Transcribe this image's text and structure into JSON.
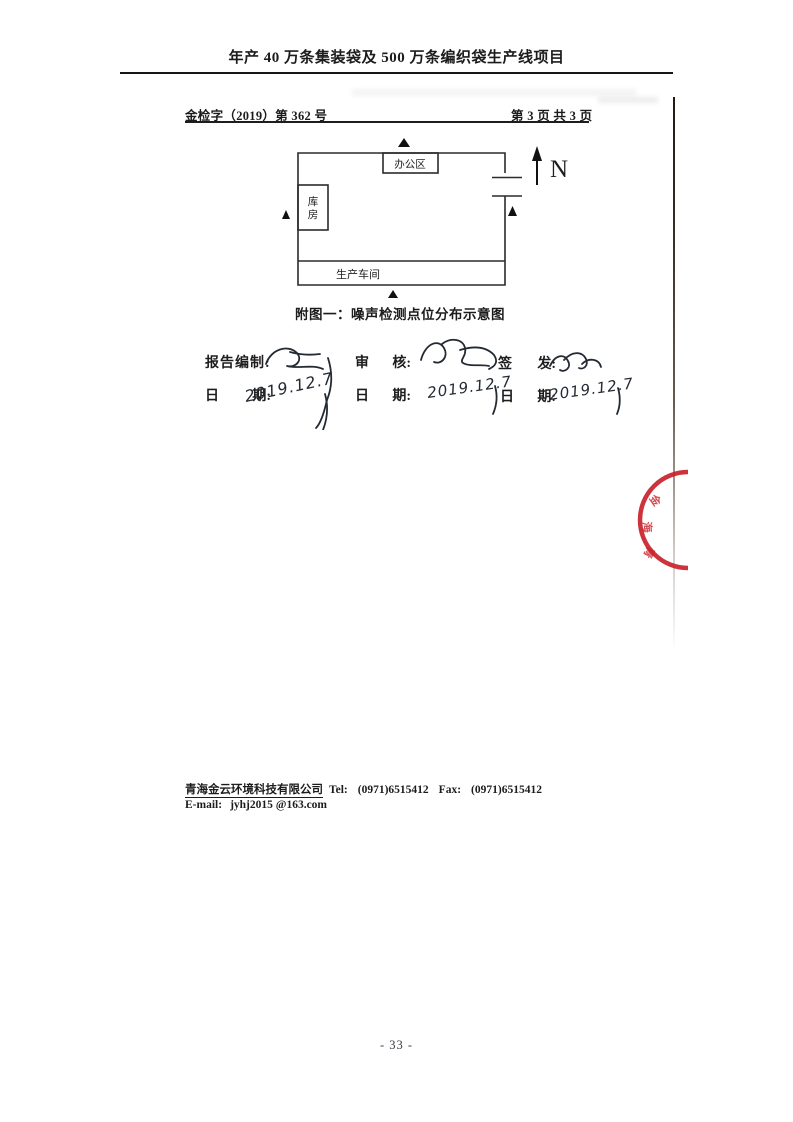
{
  "page": {
    "title": "年产 40 万条集装袋及 500 万条编织袋生产线项目",
    "page_number": "- 33 -"
  },
  "doc_header": {
    "ref_number": "金检字（2019）第 362 号",
    "pagination": "第 3 页 共 3 页"
  },
  "diagram": {
    "caption": "附图一：噪声检测点位分布示意图",
    "north_label": "N",
    "rooms": {
      "office": "办公区",
      "warehouse_line1": "库",
      "warehouse_line2": "房",
      "workshop": "生产车间"
    },
    "noise_point_count": 4
  },
  "signoff": {
    "prepared_label": "报告编制:",
    "review_chars": [
      "审",
      "核:"
    ],
    "issue_chars": [
      "签",
      "发:"
    ],
    "date_chars": [
      "日",
      "期:"
    ],
    "prepared_date": "2019.12.7",
    "review_date": "2019.12.7",
    "issue_date": "2019.12.7"
  },
  "stamp": {
    "visible_chars": [
      "金",
      "海",
      "青"
    ],
    "color": "#c8222a"
  },
  "footer": {
    "company": "青海金云环境科技有限公司",
    "tel_label": "Tel:",
    "tel": "(0971)6515412",
    "fax_label": "Fax:",
    "fax": "(0971)6515412",
    "email_label": "E-mail:",
    "email": "jyhj2015 @163.com"
  }
}
